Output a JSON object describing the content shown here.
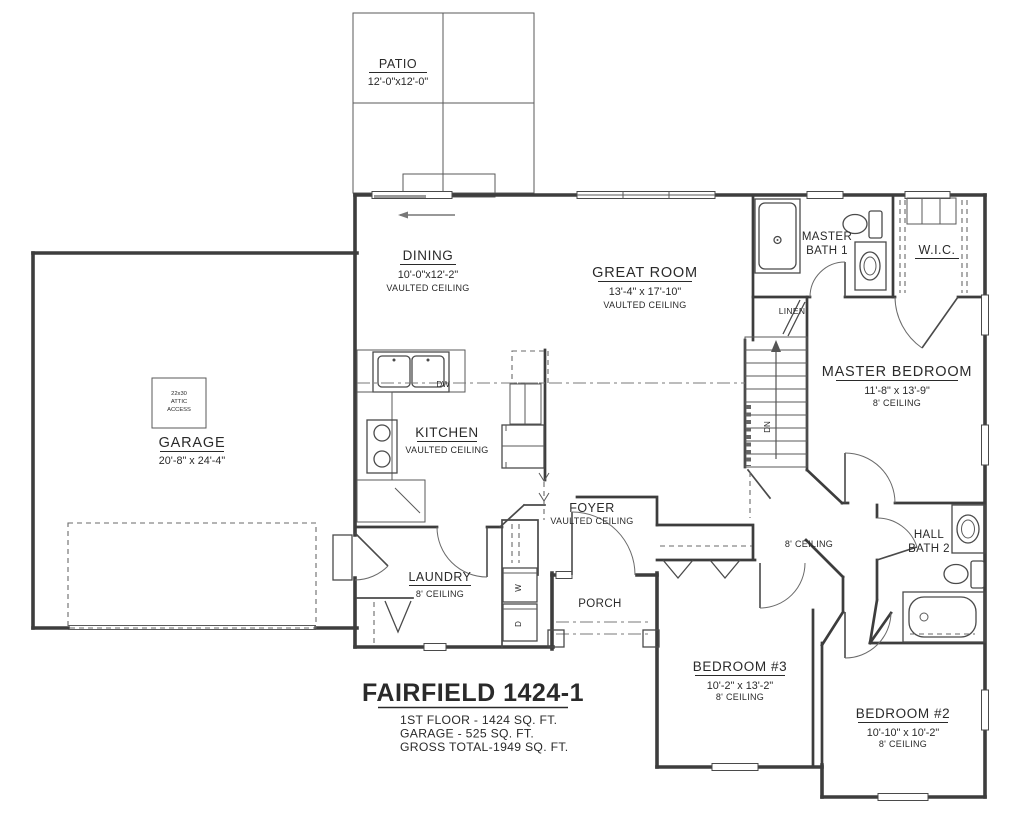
{
  "rooms": {
    "patio": {
      "name": "PATIO",
      "dims": "12'-0\"x12'-0\""
    },
    "dining": {
      "name": "DINING",
      "dims": "10'-0\"x12'-2\"",
      "note": "VAULTED CEILING"
    },
    "great_room": {
      "name": "GREAT ROOM",
      "dims": "13'-4\" x 17'-10\"",
      "note": "VAULTED CEILING"
    },
    "kitchen": {
      "name": "KITCHEN",
      "note": "VAULTED CEILING",
      "dw": "DW"
    },
    "garage": {
      "name": "GARAGE",
      "dims": "20'-8\" x 24'-4\"",
      "attic1": "22x30",
      "attic2": "ATTIC",
      "attic3": "ACCESS"
    },
    "master_bath": {
      "l1": "MASTER",
      "l2": "BATH 1"
    },
    "wic": {
      "name": "W.I.C."
    },
    "linen": {
      "name": "LINEN"
    },
    "master_bedroom": {
      "name": "MASTER BEDROOM",
      "dims": "11'-8\" x 13'-9\"",
      "note": "8' CEILING"
    },
    "stairs": {
      "dn": "DN"
    },
    "foyer": {
      "name": "FOYER",
      "note": "VAULTED CEILING"
    },
    "laundry": {
      "name": "LAUNDRY",
      "note": "8' CEILING",
      "w": "W",
      "d": "D"
    },
    "porch": {
      "name": "PORCH"
    },
    "hall": {
      "note": "8' CEILING"
    },
    "hall_bath": {
      "l1": "HALL",
      "l2": "BATH 2"
    },
    "bedroom3": {
      "name": "BEDROOM #3",
      "dims": "10'-2\" x 13'-2\"",
      "note": "8' CEILING"
    },
    "bedroom2": {
      "name": "BEDROOM #2",
      "dims": "10'-10\" x 10'-2\"",
      "note": "8' CEILING"
    }
  },
  "title_block": {
    "name": "FAIRFIELD 1424-1",
    "line1": "1ST FLOOR - 1424 SQ. FT.",
    "line2": "GARAGE - 525 SQ. FT.",
    "line3": "GROSS TOTAL-1949 SQ. FT."
  }
}
